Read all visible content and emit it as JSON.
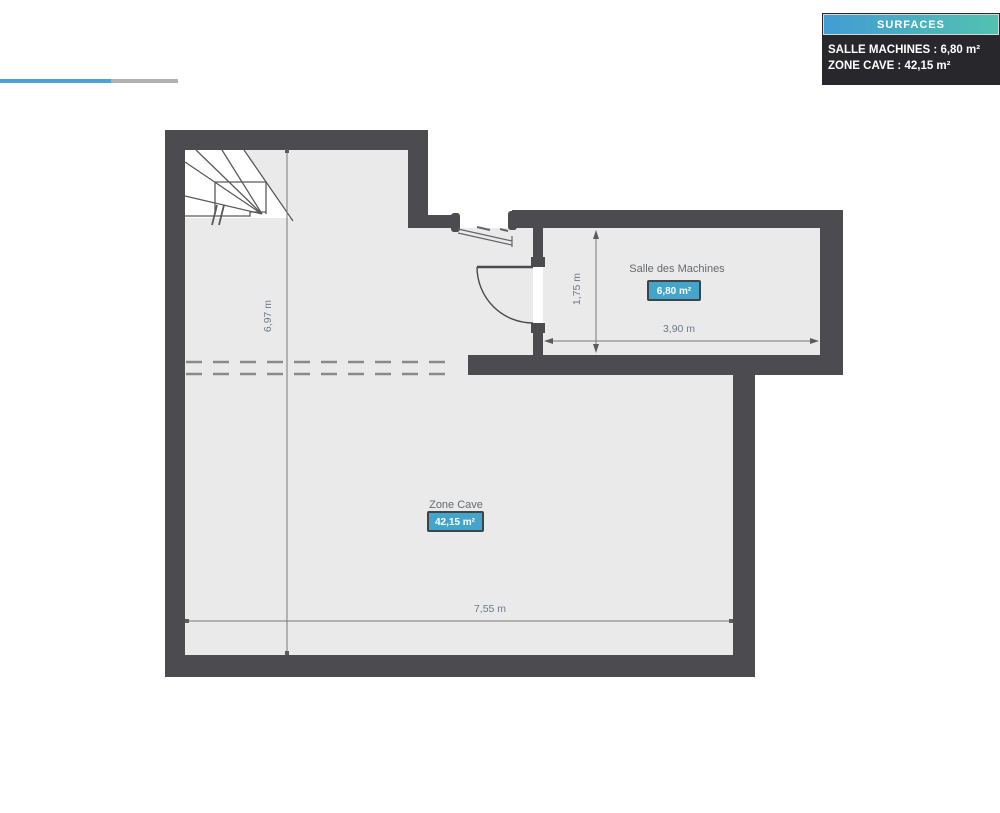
{
  "legend": {
    "title": "SURFACES",
    "items": [
      "SALLE MACHINES : 6,80 m²",
      "ZONE CAVE : 42,15 m²"
    ]
  },
  "rooms": [
    {
      "name": "Salle des Machines",
      "area": "6,80 m²"
    },
    {
      "name": "Zone Cave",
      "area": "42,15 m²"
    }
  ],
  "dimensions": {
    "left_height": "6,97 m",
    "machine_height": "1,75 m",
    "machine_width": "3,90 m",
    "cave_width": "7,55 m"
  },
  "colors": {
    "wall": "#4b4b50",
    "floor": "#eaeaeb",
    "badge_fill": "#43a5c9",
    "badge_border": "#3e4449",
    "dim_line": "#787878",
    "dim_text": "#6e7a87",
    "label_text": "#66696c",
    "legend_header_start": "#429cd4",
    "legend_header_end": "#52c2b0",
    "legend_body_bg": "#28282c",
    "scroll_thumb": "#4aa3d8",
    "scroll_track": "#b2b2b2"
  }
}
